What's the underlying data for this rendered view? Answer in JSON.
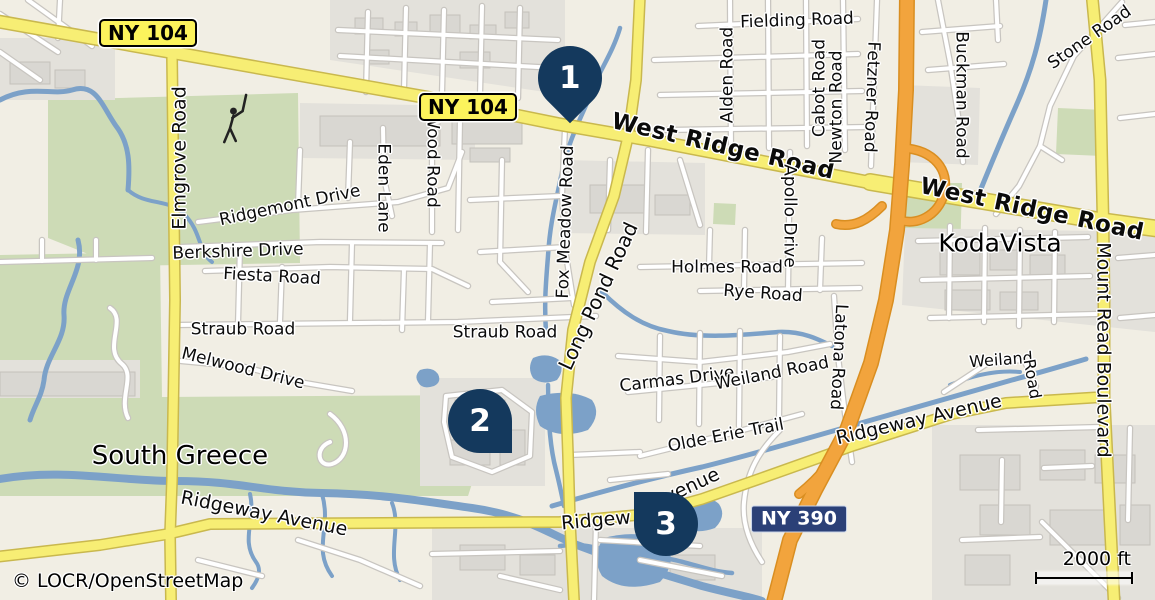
{
  "map": {
    "attribution": "© LOCR/OpenStreetMap",
    "scale_bar": {
      "label": "2000 ft"
    },
    "colors": {
      "marker": "#14395d",
      "shield_yellow": "#fcf35c",
      "shield_blue": "#2b4077",
      "road_yellow": "#f7ee74",
      "motorway_orange": "#f2a43d",
      "water": "#7ca1c8",
      "green_area": "#cddbb6",
      "urban_gray": "#e3e1db"
    },
    "shields": [
      {
        "name": "shield-ny104-west",
        "text": "NY 104",
        "x": 148,
        "y": 33,
        "type": "yellow"
      },
      {
        "name": "shield-ny104-east",
        "text": "NY 104",
        "x": 468,
        "y": 107,
        "type": "yellow"
      },
      {
        "name": "shield-ny390",
        "text": "NY 390",
        "x": 799,
        "y": 519,
        "type": "blue"
      }
    ],
    "markers": [
      {
        "name": "map-pin-1",
        "number": "1",
        "x": 570,
        "y": 78,
        "tip": "down"
      },
      {
        "name": "map-pin-2",
        "number": "2",
        "x": 480,
        "y": 421,
        "tip": "down-right"
      },
      {
        "name": "map-pin-3",
        "number": "3",
        "x": 666,
        "y": 524,
        "tip": "up-left"
      }
    ],
    "place_labels": [
      {
        "name": "place-south-greece",
        "text": "South Greece",
        "x": 180,
        "y": 456,
        "rot": 0,
        "size": 26
      },
      {
        "name": "place-kodavista",
        "text": "KodaVista",
        "x": 1000,
        "y": 243,
        "rot": 0,
        "size": 25
      }
    ],
    "road_labels": [
      {
        "name": "label-west-ridge-road-1",
        "text": "West Ridge Road",
        "x": 723,
        "y": 147,
        "rot": 13,
        "size": 23,
        "major": true
      },
      {
        "name": "label-west-ridge-road-2",
        "text": "West Ridge Road",
        "x": 1032,
        "y": 210,
        "rot": 12,
        "size": 23,
        "major": true
      },
      {
        "name": "label-stone-road",
        "text": "Stone Road",
        "x": 1090,
        "y": 38,
        "rot": -35,
        "size": 17
      },
      {
        "name": "label-fielding-road",
        "text": "Fielding Road",
        "x": 797,
        "y": 21,
        "rot": -2,
        "size": 17
      },
      {
        "name": "label-alden-road",
        "text": "Alden Road",
        "x": 728,
        "y": 75,
        "rot": -90,
        "size": 17
      },
      {
        "name": "label-cabot-road",
        "text": "Cabot Road",
        "x": 820,
        "y": 88,
        "rot": -90,
        "size": 17
      },
      {
        "name": "label-newton-road",
        "text": "Newton Road",
        "x": 837,
        "y": 107,
        "rot": -90,
        "size": 17
      },
      {
        "name": "label-fetzner-road",
        "text": "Fetzner Road",
        "x": 871,
        "y": 97,
        "rot": 92,
        "size": 17
      },
      {
        "name": "label-buckman-road",
        "text": "Buckman Road",
        "x": 961,
        "y": 95,
        "rot": 90,
        "size": 17
      },
      {
        "name": "label-elmgrove-road",
        "text": "Elmgrove Road",
        "x": 180,
        "y": 158,
        "rot": -90,
        "size": 19
      },
      {
        "name": "label-ridgemont-drive",
        "text": "Ridgemont Drive",
        "x": 290,
        "y": 206,
        "rot": -12,
        "size": 17
      },
      {
        "name": "label-eden-lane",
        "text": "Eden Lane",
        "x": 383,
        "y": 188,
        "rot": 90,
        "size": 17
      },
      {
        "name": "label-wood-road",
        "text": "Wood Road",
        "x": 432,
        "y": 160,
        "rot": 90,
        "size": 17
      },
      {
        "name": "label-berkshire-drive",
        "text": "Berkshire Drive",
        "x": 238,
        "y": 252,
        "rot": -2,
        "size": 17
      },
      {
        "name": "label-fiesta-road",
        "text": "Fiesta Road",
        "x": 272,
        "y": 277,
        "rot": 3,
        "size": 17
      },
      {
        "name": "label-straub-road-west",
        "text": "Straub Road",
        "x": 243,
        "y": 330,
        "rot": 0,
        "size": 17
      },
      {
        "name": "label-melwood-drive",
        "text": "Melwood Drive",
        "x": 243,
        "y": 369,
        "rot": 14,
        "size": 17
      },
      {
        "name": "label-straub-road-east",
        "text": "Straub Road",
        "x": 505,
        "y": 333,
        "rot": 0,
        "size": 17
      },
      {
        "name": "label-fox-meadow-road",
        "text": "Fox Meadow Road",
        "x": 566,
        "y": 222,
        "rot": -88,
        "size": 17
      },
      {
        "name": "label-long-pond-road",
        "text": "Long Pond Road",
        "x": 598,
        "y": 296,
        "rot": -65,
        "size": 20
      },
      {
        "name": "label-holmes-road",
        "text": "Holmes Road",
        "x": 727,
        "y": 268,
        "rot": 0,
        "size": 17
      },
      {
        "name": "label-rye-road",
        "text": "Rye Road",
        "x": 763,
        "y": 294,
        "rot": 4,
        "size": 17
      },
      {
        "name": "label-apollo-drive",
        "text": "Apollo Drive",
        "x": 789,
        "y": 216,
        "rot": 90,
        "size": 17
      },
      {
        "name": "label-carmas-drive",
        "text": "Carmas Drive",
        "x": 677,
        "y": 380,
        "rot": -7,
        "size": 17
      },
      {
        "name": "label-weiland-road-west",
        "text": "Weiland Road",
        "x": 772,
        "y": 374,
        "rot": -11,
        "size": 17
      },
      {
        "name": "label-weiland-right",
        "text": "Weiland",
        "x": 1001,
        "y": 360,
        "rot": -4,
        "size": 16
      },
      {
        "name": "label-weiland-right-2",
        "text": "Road",
        "x": 1032,
        "y": 379,
        "rot": 80,
        "size": 16
      },
      {
        "name": "label-olde-erie-trail",
        "text": "Olde Erie Trail",
        "x": 726,
        "y": 436,
        "rot": -11,
        "size": 17
      },
      {
        "name": "label-latona-road",
        "text": "Latona Road",
        "x": 838,
        "y": 357,
        "rot": 93,
        "size": 17
      },
      {
        "name": "label-mount-read-blvd",
        "text": "Mount Read Boulevard",
        "x": 1103,
        "y": 350,
        "rot": 90,
        "size": 19
      },
      {
        "name": "label-ridgeway-ave-west",
        "text": "Ridgeway Avenue",
        "x": 264,
        "y": 514,
        "rot": 11,
        "size": 19
      },
      {
        "name": "label-ridgeway-center-1",
        "text": "Ridgew",
        "x": 596,
        "y": 521,
        "rot": -5,
        "size": 19
      },
      {
        "name": "label-ridgeway-center-2",
        "text": "venue",
        "x": 692,
        "y": 486,
        "rot": -25,
        "size": 19
      },
      {
        "name": "label-ridgeway-ave-east",
        "text": "Ridgeway Avenue",
        "x": 919,
        "y": 420,
        "rot": -13,
        "size": 19
      }
    ]
  }
}
